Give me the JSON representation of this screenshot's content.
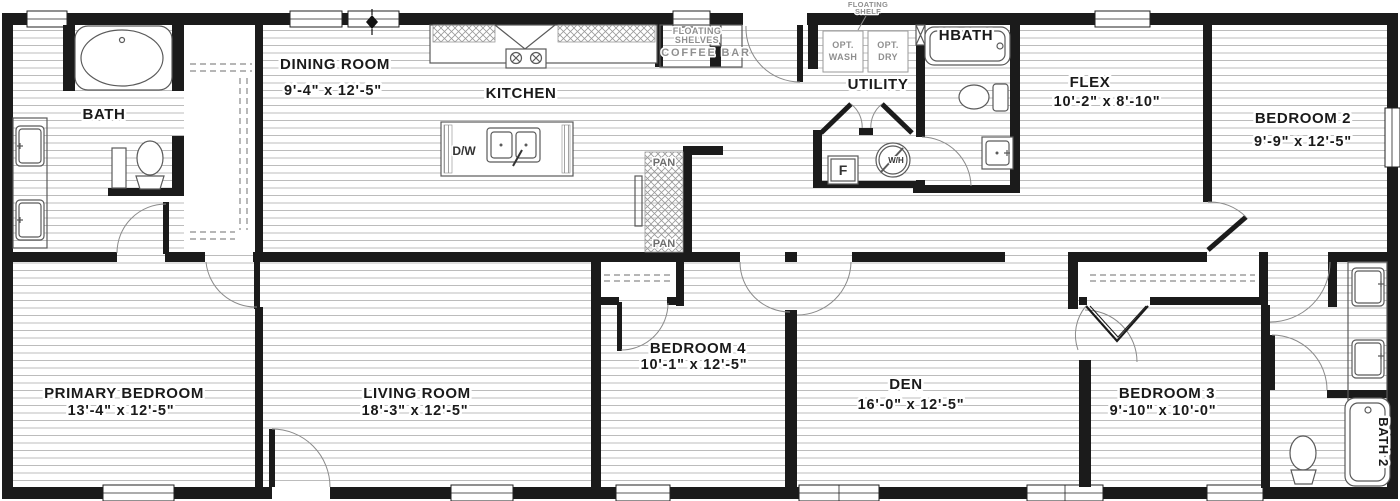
{
  "colors": {
    "wall": "#1b1b1b",
    "floorline": "#bcbcbc",
    "fixture": "#5a5a5a",
    "ink": "#1a1a1a",
    "muted": "#8f8f8f"
  },
  "plan": {
    "rooms": {
      "bath": {
        "name": "BATH"
      },
      "dining": {
        "name": "DINING ROOM",
        "dims": "9'-4\" x  12'-5\""
      },
      "kitchen": {
        "name": "KITCHEN"
      },
      "utility": {
        "name": "UTILITY"
      },
      "hbath": {
        "name": "HBATH"
      },
      "flex": {
        "name": "FLEX",
        "dims": "10'-2\" x  8'-10\""
      },
      "bedroom2": {
        "name": "BEDROOM 2",
        "dims": "9'-9\" x  12'-5\""
      },
      "primary": {
        "name": "PRIMARY BEDROOM",
        "dims": "13'-4\" x  12'-5\""
      },
      "living": {
        "name": "LIVING ROOM",
        "dims": "18'-3\" x  12'-5\""
      },
      "bedroom4": {
        "name": "BEDROOM 4",
        "dims": "10'-1\" x  12'-5\""
      },
      "den": {
        "name": "DEN",
        "dims": "16'-0\" x  12'-5\""
      },
      "bedroom3": {
        "name": "BEDROOM 3",
        "dims": "9'-10\" x  10'-0\""
      },
      "bath2": {
        "name": "BATH 2"
      }
    },
    "features": {
      "coffee_bar": "COFFEE BAR",
      "floating_shelves_line1": "FLOATING",
      "floating_shelves_line2": "SHELVES",
      "floating_shelf_line1": "FLOATING",
      "floating_shelf_line2": "SHELF",
      "opt_wash_line1": "OPT.",
      "opt_wash_line2": "WASH",
      "opt_dry_line1": "OPT.",
      "opt_dry_line2": "DRY",
      "pantry_top": "PAN",
      "pantry_bottom": "PAN",
      "dishwasher": "D/W",
      "furnace": "F",
      "water_heater": "W/H"
    }
  }
}
